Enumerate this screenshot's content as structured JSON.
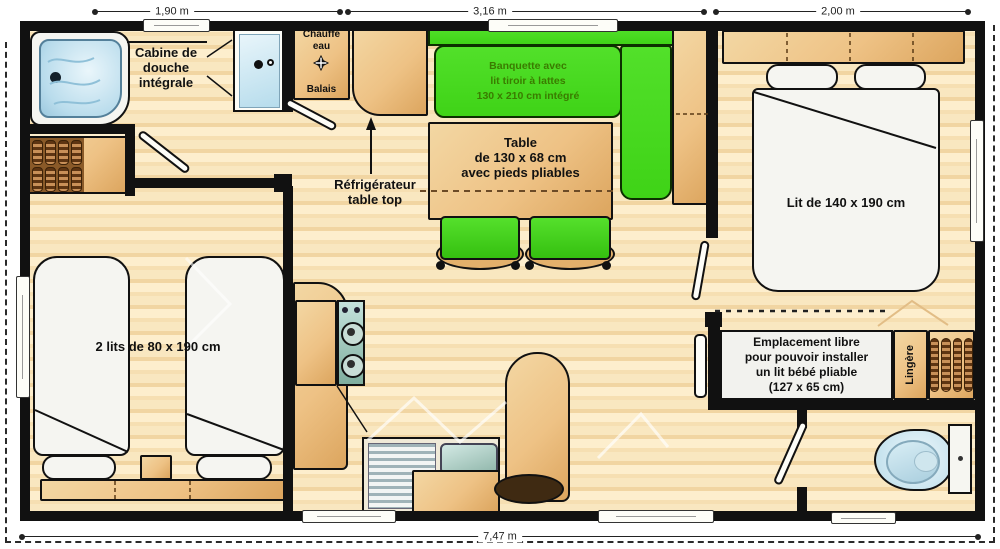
{
  "dimensions": {
    "top_left": "1,90 m",
    "top_middle": "3,16 m",
    "top_right": "2,00 m",
    "bottom_total": "7,47 m"
  },
  "labels": {
    "shower": "Cabine de\ndouche\nintégrale",
    "water_heater": "Chauffe\neau",
    "broom": "Balais",
    "fridge": "Réfrigérateur\ntable top",
    "bench": "Banquette avec\nlit tiroir à lattes\n130 x 210 cm intégré",
    "table": "Table\nde 130 x 68 cm\navec pieds pliables",
    "double_bed": "Lit de 140 x 190 cm",
    "twin_beds": "2 lits de 80 x 190 cm",
    "baby_area": "Emplacement libre\npour pouvoir installer\nun lit bébé pliable\n(127 x 65 cm)",
    "linen": "Lingère"
  },
  "colors": {
    "wall": "#111111",
    "floor_light": "#fcecca",
    "floor_mid": "#f5ddae",
    "accent_orange": "#f2c48c",
    "tan_light": "#f3d7a3",
    "tan_dark": "#dca55e",
    "bench_green": "#3fd317",
    "bench_text": "#3a7c00",
    "water_blue": "#cfe9f4",
    "bed_white": "#f5f5f1",
    "brown_dark": "#6b3c12"
  }
}
